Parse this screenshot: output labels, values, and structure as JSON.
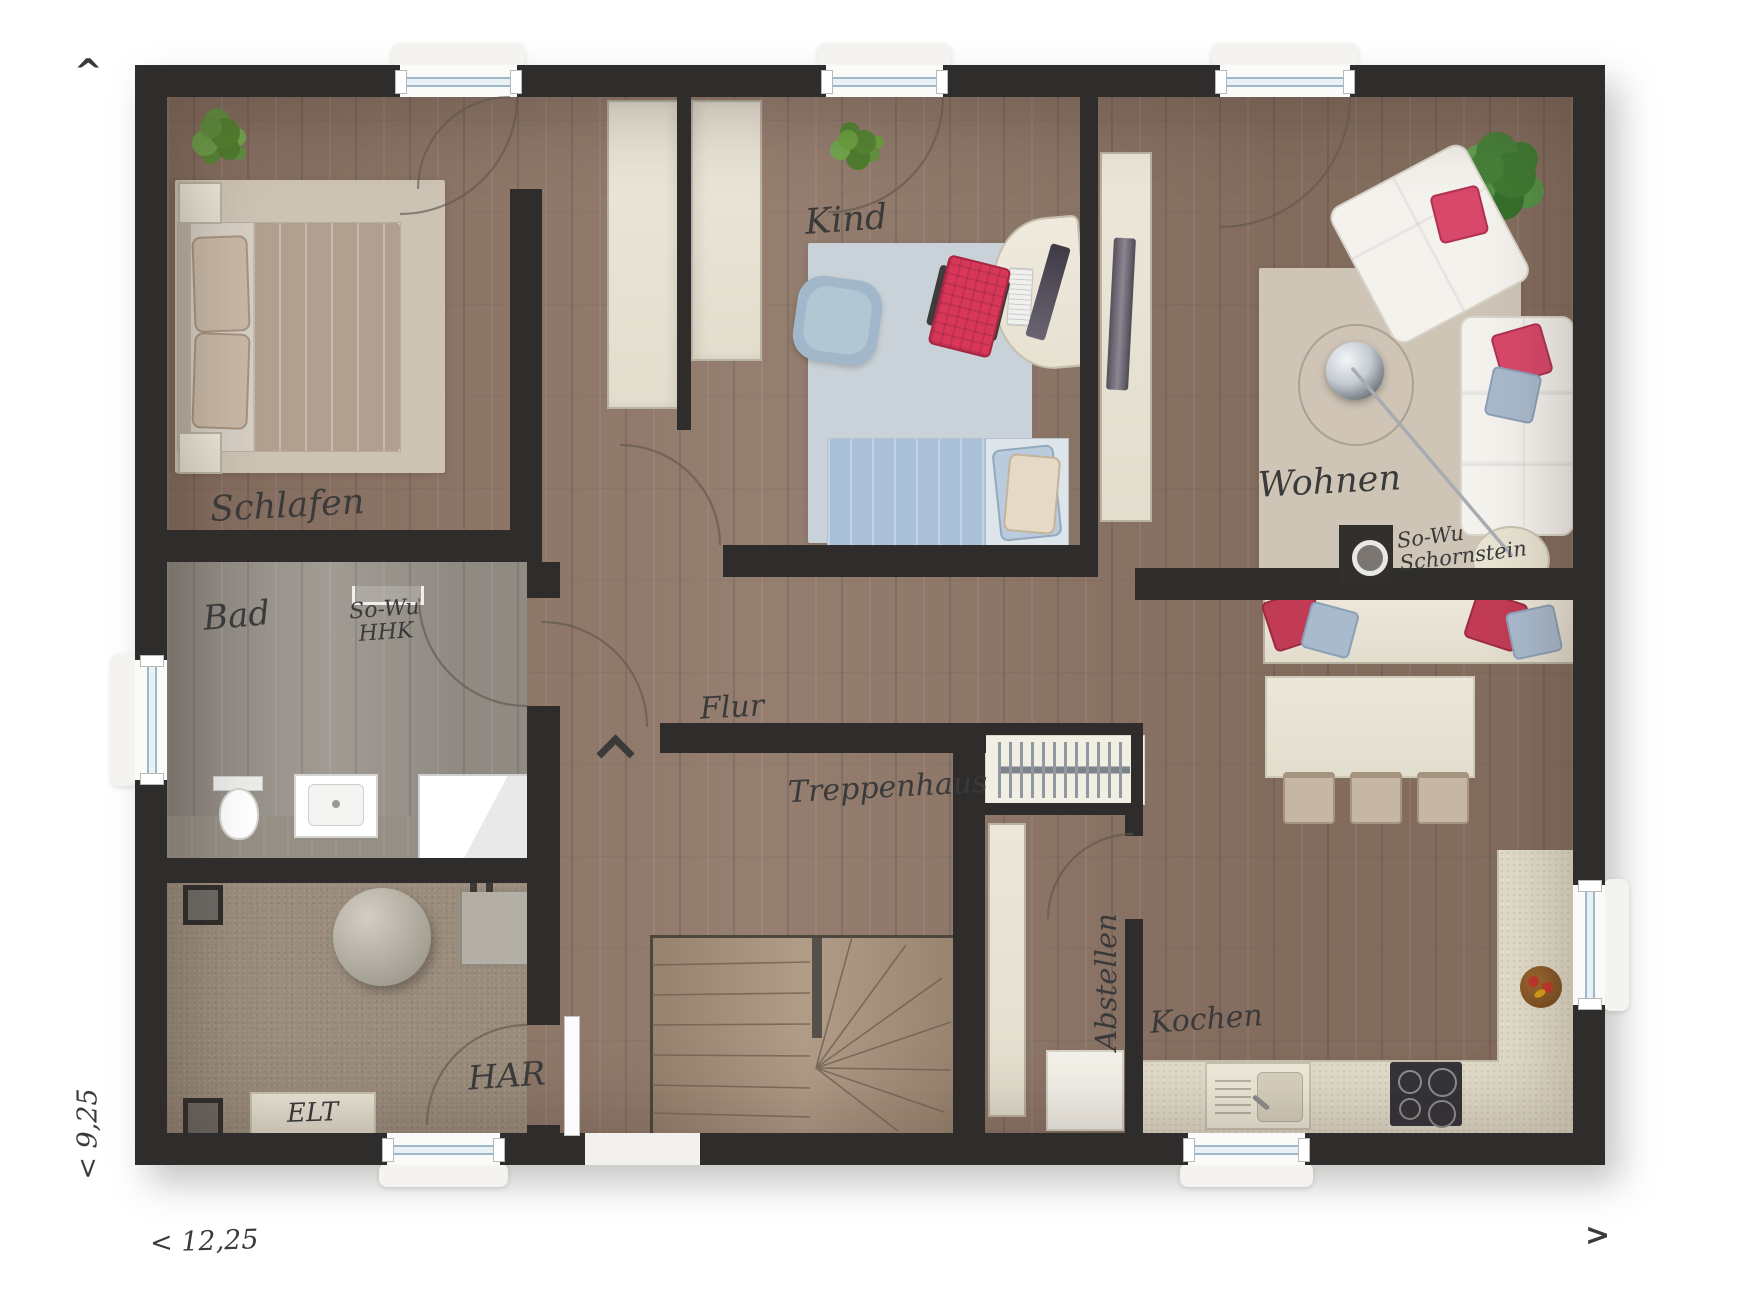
{
  "plan": {
    "rooms": {
      "schlafen": "Schlafen",
      "kind": "Kind",
      "wohnen": "Wohnen",
      "bad": "Bad",
      "flur": "Flur",
      "treppenhaus": "Treppenhaus",
      "abstellen": "Abstellen",
      "kochen": "Kochen",
      "har": "HAR",
      "elt": "ELT"
    },
    "annotations": {
      "hhk_line1": "So-Wu",
      "hhk_line2": "HHK",
      "schornstein_line1": "So-Wu",
      "schornstein_line2": "Schornstein"
    },
    "dimensions": {
      "width": "< 12,25",
      "depth": "< 9,25"
    },
    "nav": {
      "up": "^",
      "right": ">"
    },
    "colors": {
      "wall": "#2f2d2b",
      "wood": "#8d7668",
      "bath_floor": "#9a948c",
      "carpet": "#9a8c7c",
      "rug_beige": "#cdc3b4",
      "rug_blue": "#c9d2d8",
      "accent_pink": "#d8486a",
      "accent_blue": "#a9bacc",
      "furniture_cream": "#ece7d9"
    }
  }
}
